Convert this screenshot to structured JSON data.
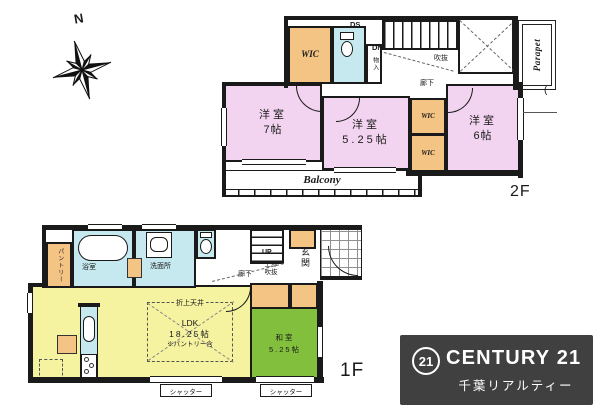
{
  "compass": {
    "north": "N"
  },
  "floor2": {
    "floor_label": "2F",
    "duct_label": "DS",
    "stairs_label": "DN",
    "wic_top_label": "WIC",
    "storage_label": "物入",
    "void_label": "吹抜",
    "hallway_label": "廊下",
    "parapet_label": "Parapet",
    "window_note": "(",
    "rooms": {
      "west": {
        "name": "洋室",
        "size": "7帖"
      },
      "center": {
        "name": "洋室",
        "size": "5.25帖"
      },
      "east": {
        "name": "洋室",
        "size": "6帖"
      }
    },
    "wic_a_label": "WIC",
    "wic_b_label": "WIC",
    "balcony_label": "Balcony"
  },
  "floor1": {
    "floor_label": "1F",
    "pantry_label": "パントリー",
    "bath_label": "浴室",
    "washroom_label": "洗面所",
    "hallway_label": "廊下",
    "stairs_label": "UP",
    "upper_void_line1": "上部",
    "upper_void_line2": "吹抜",
    "entrance_label": "玄関",
    "ldk": {
      "ceiling_label": "折上天井",
      "name": "LDK",
      "size": "18.25帖",
      "note": "※パントリー含"
    },
    "washitsu": {
      "name": "和室",
      "size": "5.25帖"
    },
    "shutter_left_label": "シャッター",
    "shutter_right_label": "シャッター"
  },
  "logo": {
    "badge": "21",
    "brand": "CENTURY 21",
    "company": "千葉リアルティー"
  },
  "colors": {
    "pink": "#f3d4f0",
    "orange": "#f4c484",
    "cyan": "#c6e9f0",
    "yellow": "#f5f2a0",
    "green": "#82bf3c",
    "wall": "#1a1a1a",
    "logo_bg": "#404040",
    "logo_text": "#ffffff"
  }
}
